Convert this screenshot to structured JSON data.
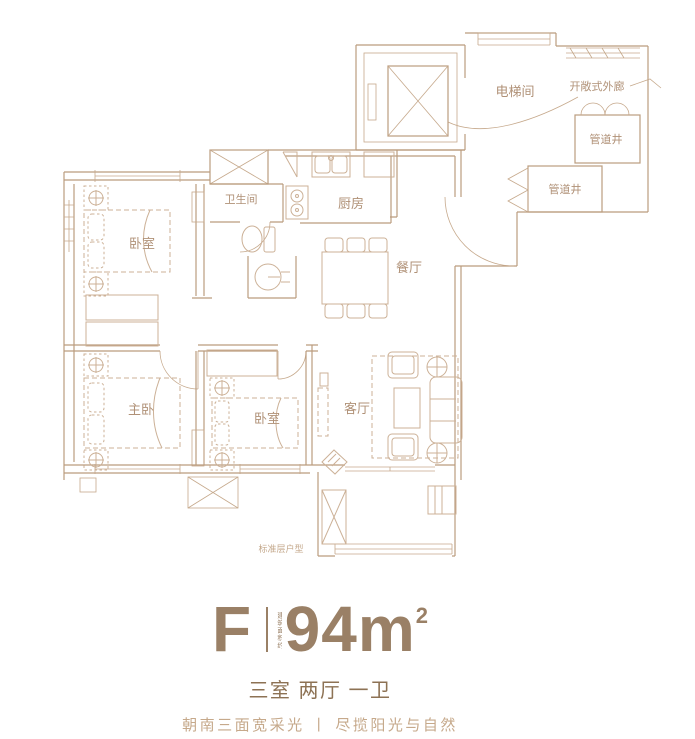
{
  "plan": {
    "note": "标准层户型",
    "rooms": {
      "elevator": "电梯间",
      "corridor": "开敞式外廊",
      "shaft1": "管道井",
      "shaft2": "管道井",
      "bathroom": "卫生间",
      "kitchen": "厨房",
      "dining": "餐厅",
      "bedroom1": "卧室",
      "master": "主卧",
      "bedroom2": "卧室",
      "living": "客厅"
    }
  },
  "summary": {
    "unit": "F",
    "area_value": "94",
    "area_unit": "m",
    "area_exponent": "2",
    "area_prefix_vertical": "建筑面积约",
    "layout": "三室 两厅 一卫",
    "tagline": "朝南三面宽采光 丨 尽揽阳光与自然"
  },
  "colors": {
    "wall_line": "#bb9c7e",
    "furniture_line": "#ccb197",
    "room_label": "#b09177",
    "headline": "#9a8066",
    "layout_text": "#8d7254",
    "tagline_text": "#c6a98b",
    "background": "#ffffff"
  }
}
